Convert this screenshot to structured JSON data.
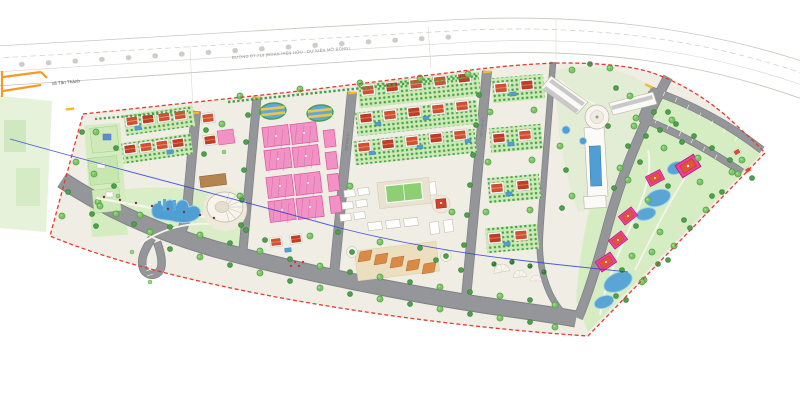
{
  "map": {
    "labels": {
      "commune": "xã Tân Thành",
      "highway": "ĐƯỜNG ĐT.719 (ĐOẠN HIỆN HỮU - DỰ KIẾN MỞ RỘNG)",
      "road_section_v3": "LỘ GIỚI 13M",
      "road_section_v4": "LỘ GIỚI 13M"
    },
    "icons": {
      "commune_marker": "orange-road-marker"
    },
    "colors": {
      "boundary_red": "#e23b2e",
      "road_gray": "#94969a",
      "road_casing": "#7f8184",
      "green_light": "#d9eec6",
      "green_mid": "#79c464",
      "green_dark": "#3e9141",
      "villa_roof": "#d4502e",
      "villa_roof_red": "#c23d22",
      "pink_block": "#f291c4",
      "pink_line": "#d9559e",
      "magenta_pavilion": "#ef3f9f",
      "water_blue": "#4f9fd4",
      "sand": "#ecdfc0",
      "canopy_orange": "#d98a45",
      "utility_line_blue": "#2b3fd0",
      "marker_orange": "#f59a23",
      "base_beige": "#f0ede4"
    }
  }
}
